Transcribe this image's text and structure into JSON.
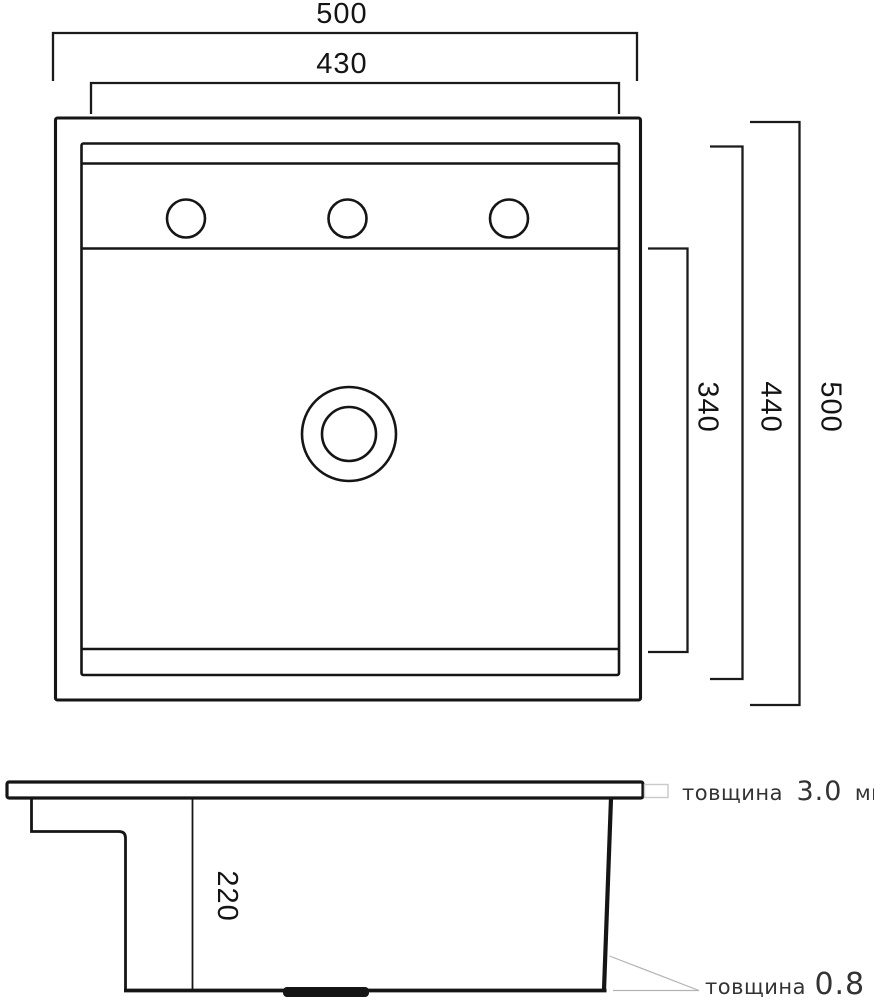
{
  "drawing_title": "sink-dimension-drawing",
  "top_view": {
    "dim_width_outer": "500",
    "dim_width_inner": "430",
    "dim_bowl_inner_height": "340",
    "dim_height_inner": "440",
    "dim_height_outer": "500",
    "faucet_hole_count": 3
  },
  "side_view": {
    "dim_bowl_depth": "220",
    "rim_thickness": {
      "label": "товщина",
      "value": "3.0",
      "unit": "мм"
    },
    "wall_thickness": {
      "label": "товщина",
      "value": "0.8",
      "unit": "мм"
    }
  },
  "colors": {
    "background": "#ffffff",
    "line": "#151515",
    "dimension_text": "#141414",
    "callout_text": "#333333",
    "leader_line": "#b3b3b3",
    "callout_box_border": "#c9c9c9"
  }
}
